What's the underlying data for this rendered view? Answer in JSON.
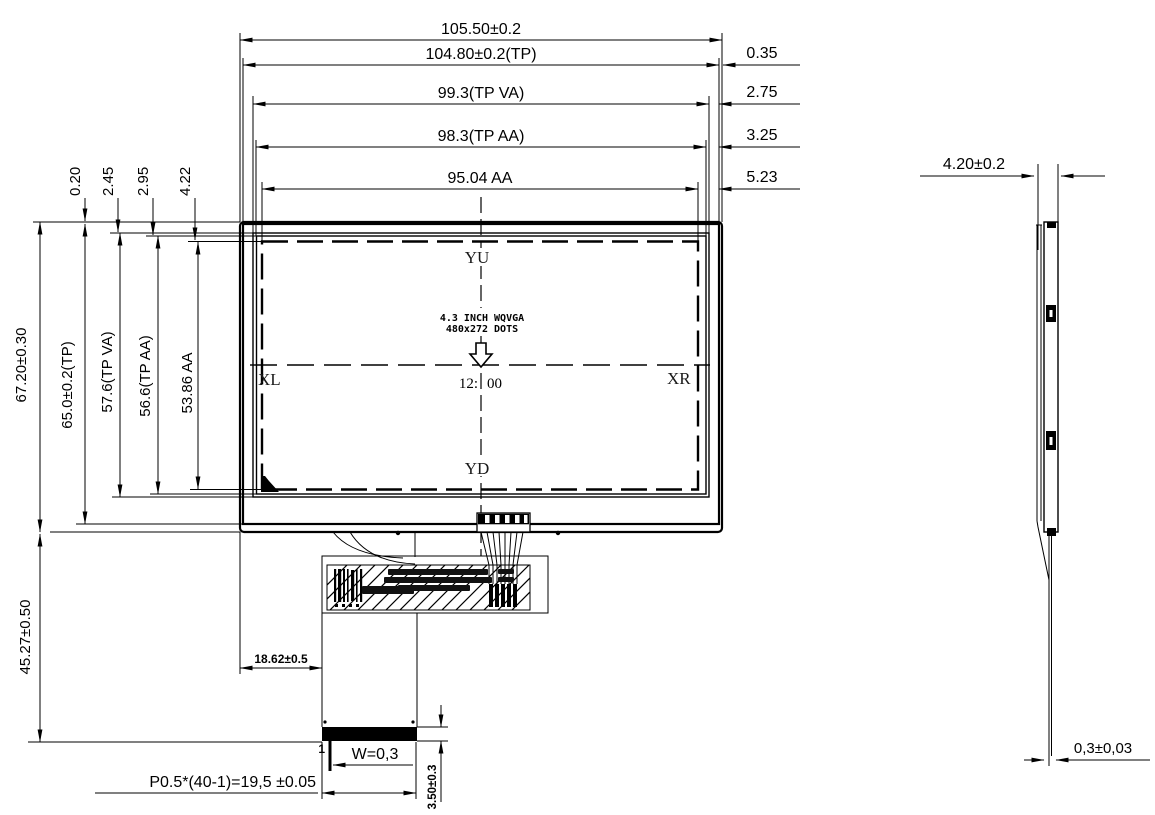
{
  "drawing_title": "lcd-module-outline-drawing",
  "front": {
    "top_dims": [
      "105.50±0.2",
      "104.80±0.2(TP)",
      "99.3(TP VA)",
      "98.3(TP AA)",
      "95.04 AA"
    ],
    "right_offsets": [
      "0.35",
      "2.75",
      "3.25",
      "5.23"
    ],
    "top_left_offsets": [
      "0.20",
      "2.45",
      "2.95",
      "4.22"
    ],
    "left_dims": [
      "67.20±0.30",
      "65.0±0.2(TP)",
      "57.6(TP VA)",
      "56.6(TP AA)",
      "53.86 AA"
    ],
    "fpc_height_dim": "45.27±0.50",
    "markers": {
      "up": "YU",
      "left": "XL",
      "right": "XR",
      "down": "YD"
    },
    "spec": {
      "line1": "4.3 INCH WQVGA",
      "line2": "480x272 DOTS"
    },
    "clock_left": "12:",
    "clock_right": "00",
    "fpc_offset_dim": "18.62±0.5",
    "pin_width_dim": "W=0,3",
    "pitch_dim": "P0.5*(40-1)=19,5 ±0.05",
    "connector_height_dim": "3.50±0.3",
    "pin_one_label": "1"
  },
  "side": {
    "thickness_dim": "4.20±0.2",
    "fpc_thickness_dim": "0,3±0,03"
  },
  "colors": {
    "ink": "#000000",
    "paper": "#ffffff"
  }
}
